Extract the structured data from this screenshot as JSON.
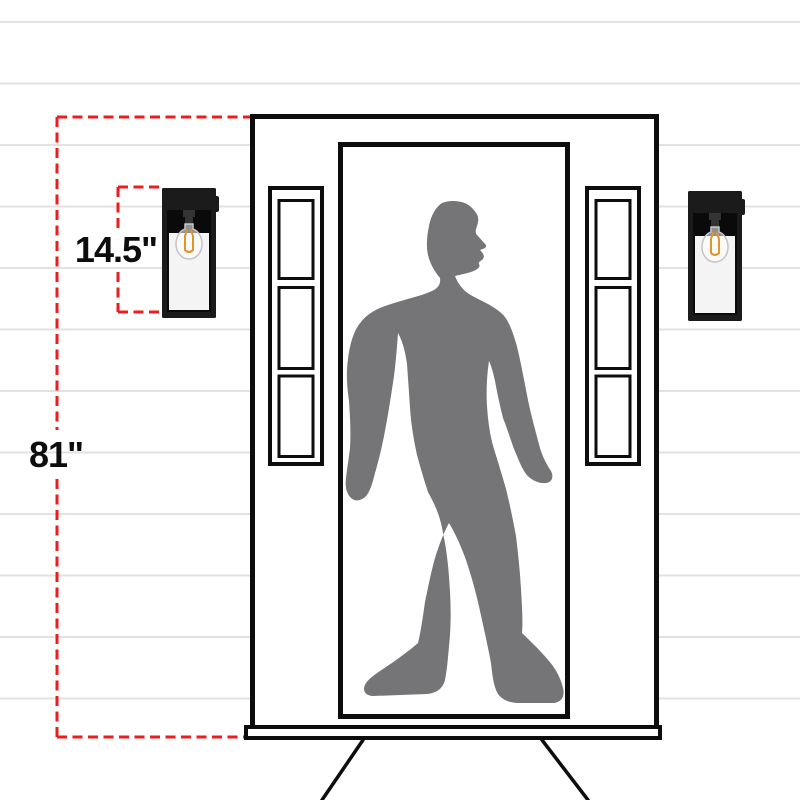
{
  "labels": {
    "fixture_height": "14.5\"",
    "mount_height": "81\""
  },
  "colors": {
    "accent": "#ee1c1f",
    "ink": "#0d0d0d",
    "silhouette": "#757578",
    "siding": "#e2e2e2",
    "glass": "#f4f4f4",
    "filament": "#e0962f",
    "fixture": "#1b1b1b"
  }
}
